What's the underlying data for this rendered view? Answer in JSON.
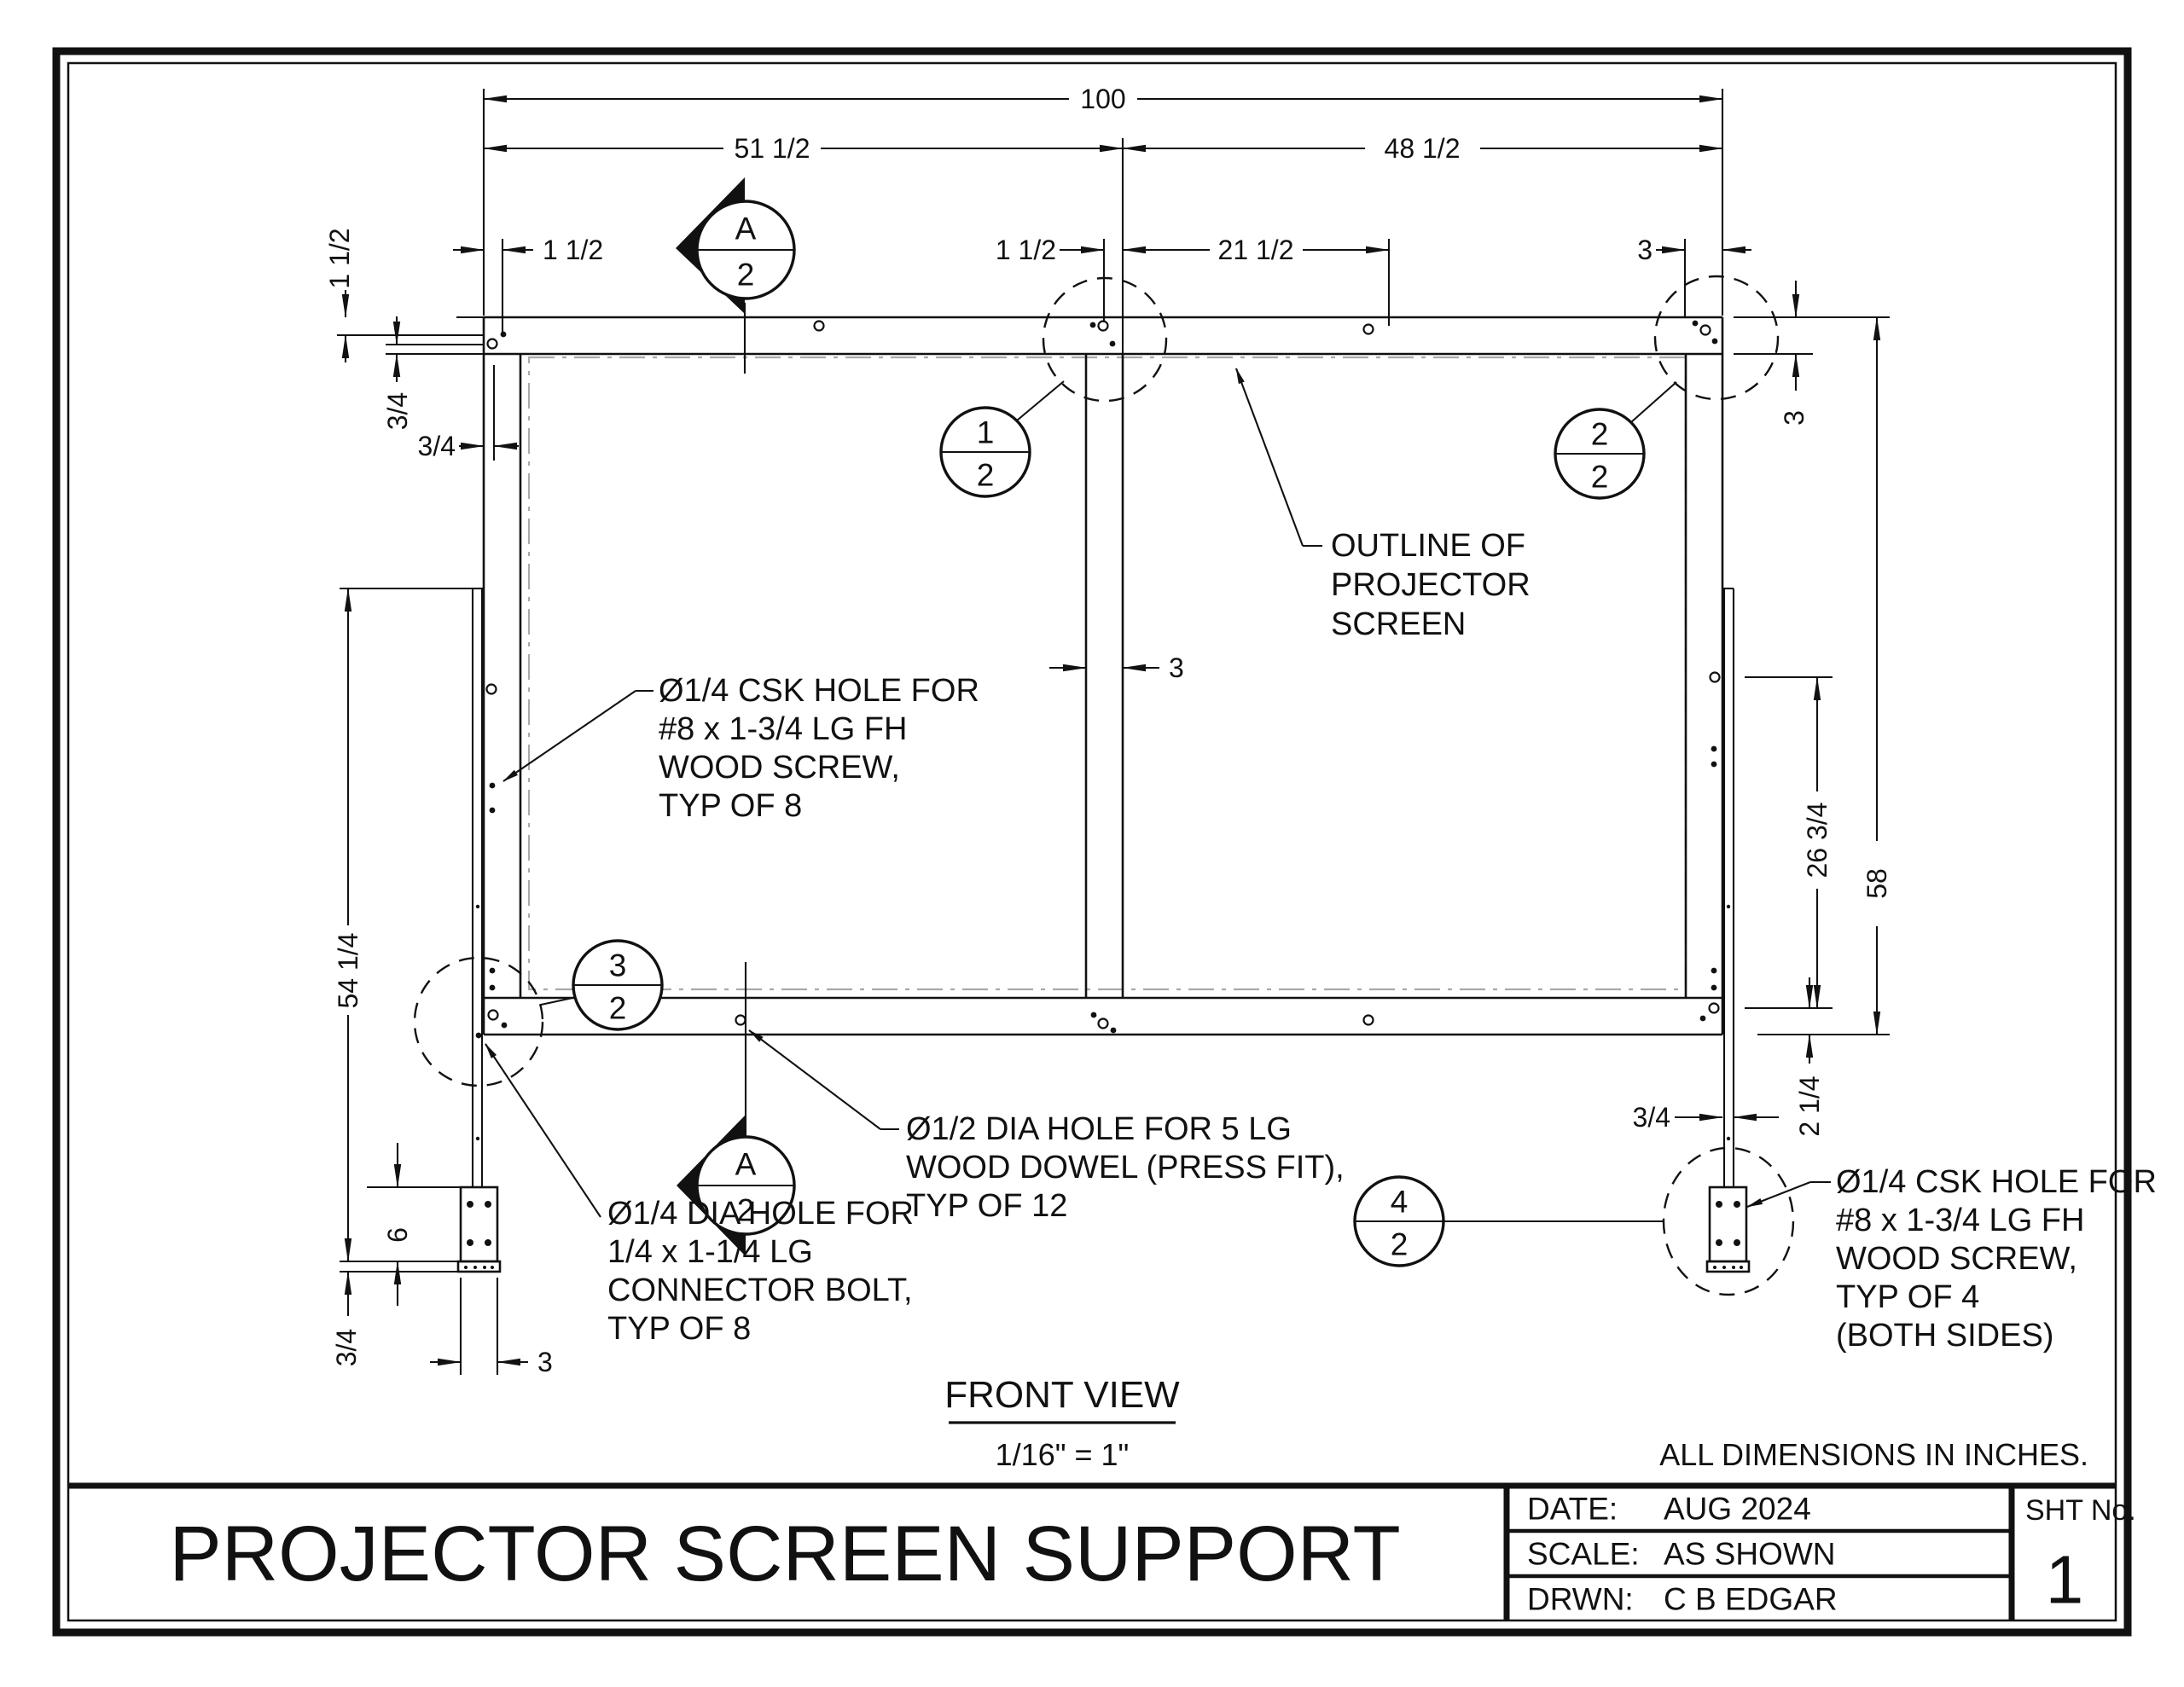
{
  "sheet": {
    "background": "#ffffff",
    "line_color": "#111111",
    "ghost_color": "#a9a9a9"
  },
  "dims": {
    "overall_w": "100",
    "left_span": "51 1/2",
    "right_span": "48 1/2",
    "edge_offset": "1 1/2",
    "mid_offset": "1 1/2",
    "mid_span": "21 1/2",
    "right_offset": "3",
    "v_edge": "1 1/2",
    "v_inset": "3/4",
    "h_inset": "3/4",
    "cleat_len": "54 1/4",
    "block_h": "6",
    "plate_t": "3/4",
    "block_w": "3",
    "rail_h": "3",
    "overall_h": "58",
    "stile_span": "26 3/4",
    "rail_inset": "2 1/4",
    "cleat_t": "3/4",
    "center_w": "3"
  },
  "balloons": {
    "b1": {
      "top": "1",
      "bot": "2"
    },
    "b2": {
      "top": "2",
      "bot": "2"
    },
    "b3": {
      "top": "3",
      "bot": "2"
    },
    "b4": {
      "top": "4",
      "bot": "2"
    },
    "section": {
      "top": "A",
      "bot": "2"
    }
  },
  "callouts": {
    "outline": [
      "OUTLINE OF",
      "PROJECTOR",
      "SCREEN"
    ],
    "csk8": [
      "Ø1/4 CSK HOLE FOR",
      "#8 x 1-3/4 LG FH",
      "WOOD SCREW,",
      "TYP OF 8"
    ],
    "dowel": [
      "Ø1/2 DIA HOLE FOR 5 LG",
      "WOOD DOWEL (PRESS FIT),",
      "TYP OF 12"
    ],
    "bolt": [
      "Ø1/4 DIA HOLE FOR",
      "1/4 x 1-1/4 LG",
      "CONNECTOR BOLT,",
      "TYP OF 8"
    ],
    "csk4": [
      "Ø1/4 CSK HOLE FOR",
      "#8 x 1-3/4 LG FH",
      "WOOD SCREW,",
      "TYP OF 4",
      "(BOTH SIDES)"
    ]
  },
  "view": {
    "title": "FRONT VIEW",
    "scale": "1/16\" = 1\""
  },
  "note": "ALL DIMENSIONS IN INCHES.",
  "titleblock": {
    "title": "PROJECTOR SCREEN SUPPORT",
    "date_label": "DATE:",
    "date": "AUG 2024",
    "scale_label": "SCALE:",
    "scale": "AS SHOWN",
    "drawn_label": "DRWN:",
    "drawn": "C B EDGAR",
    "sheet_label": "SHT No.",
    "sheet_no": "1"
  }
}
